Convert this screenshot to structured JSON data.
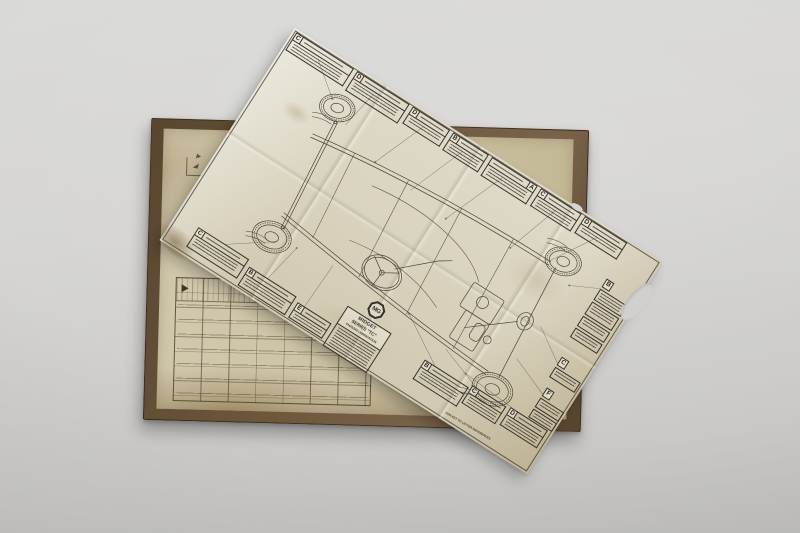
{
  "colors": {
    "background": "#d6d5d3",
    "book_cover": "#6a553b",
    "book_page": "#cbc1a2",
    "foldout_paper": "#d8d2bd",
    "ink": "#35312a"
  },
  "foldout": {
    "badge_text": "MG",
    "title": {
      "line1": "MIDGET",
      "line2": "SERIES \"TC\"",
      "line3": "CHASSIS LUBRICATION"
    },
    "footnote_fragment": "FOR KEY TO LETTER REFERENCES",
    "callouts": [
      {
        "letter": "C"
      },
      {
        "letter": "D"
      },
      {
        "letter": "D"
      },
      {
        "letter": "B"
      },
      {
        "letter": "A"
      },
      {
        "letter": "C"
      },
      {
        "letter": "D"
      },
      {
        "letter": "B"
      },
      {
        "letter": "C"
      },
      {
        "letter": "F"
      },
      {
        "letter": "C"
      },
      {
        "letter": "B"
      },
      {
        "letter": "E"
      },
      {
        "letter": "B"
      },
      {
        "letter": "C"
      },
      {
        "letter": "D"
      }
    ]
  }
}
